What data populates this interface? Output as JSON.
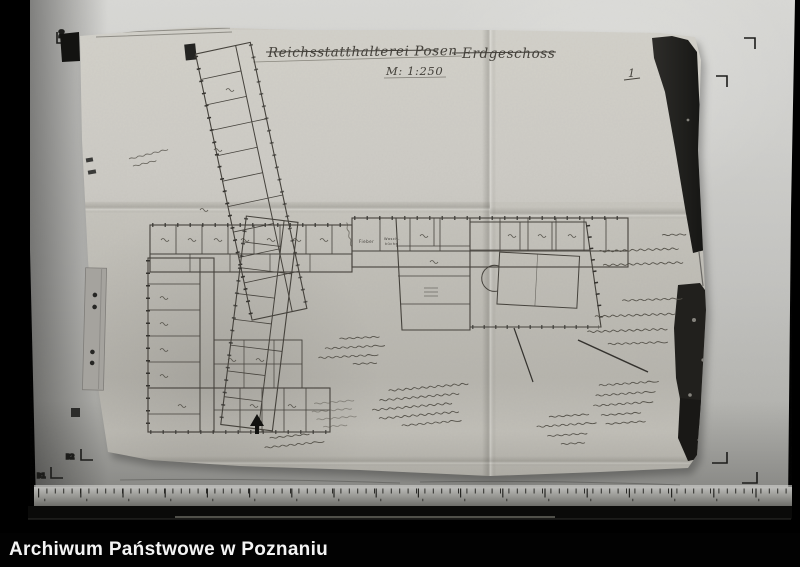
{
  "archive_bar": {
    "caption": "Archiwum Państwowe w Poznaniu"
  },
  "film_frame": {
    "marks": {
      "outer_top_left": "D0",
      "inner_top_left": "B1",
      "inner_bottom_left": "B2",
      "outer_bottom_left": "D1"
    }
  },
  "document": {
    "title": "Reichsstatthalterei Posen",
    "floor_label": "Erdgeschoss",
    "scale_note": "M: 1:250",
    "page_number": "1",
    "room_labels": {
      "fieber": "Fieber",
      "wasch_line1": "Wasch-",
      "wasch_line2": "küche"
    }
  },
  "colors": {
    "background": "#000000",
    "backing_board": "#c6c6c3",
    "paper": "#c4c2bb",
    "pencil": "#45423c",
    "caption_text": "#f4f4f4"
  }
}
